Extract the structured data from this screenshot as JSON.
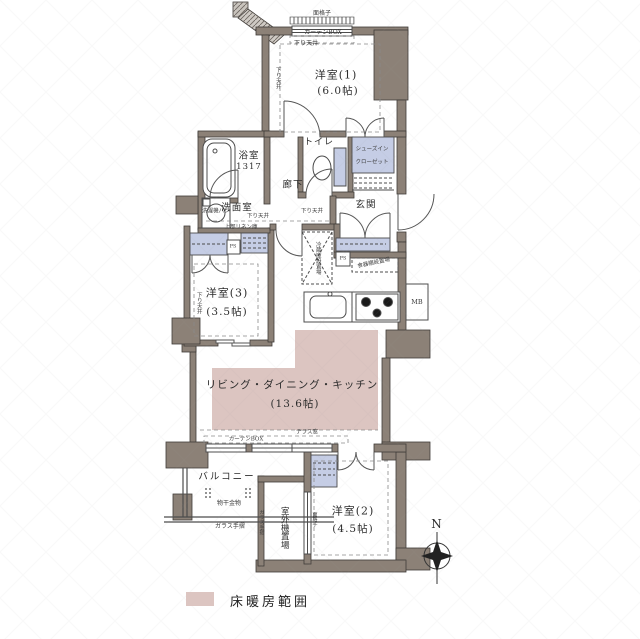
{
  "plan": {
    "rooms": {
      "western1": {
        "name": "洋室(1)",
        "size": "(6.0帖)"
      },
      "western2": {
        "name": "洋室(2)",
        "size": "(4.5帖)"
      },
      "western3": {
        "name": "洋室(3)",
        "size": "(3.5帖)"
      },
      "ldk": {
        "name": "リビング・ダイニング・キッチン",
        "size": "(13.6帖)"
      },
      "bathroom": {
        "name": "浴室",
        "size": "1317"
      },
      "washroom": {
        "name": "洗面室"
      },
      "hallway": {
        "name": "廊下"
      },
      "toilet": {
        "name": "トイレ"
      },
      "entrance": {
        "name": "玄関"
      },
      "balcony": {
        "name": "バルコニー"
      },
      "outdoor_unit": {
        "name": "室外機置場"
      }
    },
    "annotations": {
      "window_grate": "面格子",
      "curtain_box": "カーテンBOX",
      "dropped_ceiling": "下り天井",
      "washer_pan": "洗濯機パン",
      "upper_linen": "上部リネン庫",
      "shoes_closet_line1": "シューズイン",
      "shoes_closet_line2": "クローゼット",
      "fridge_space": "冷蔵庫設置場",
      "cupboard_space": "食器棚設置場",
      "pipe_space": "PS",
      "meter_box": "MB",
      "terrace_window": "テラス窓",
      "laundry_hardware": "物干金物",
      "glass_railing": "ガラス手摺"
    },
    "compass": {
      "north": "N"
    },
    "legend": {
      "floor_heating": "床暖房範囲"
    },
    "colors": {
      "wall": "#8c8177",
      "fixture_blue": "#c5cde5",
      "floor_heating": "#dcc5c1",
      "line": "#4c4c4c"
    }
  }
}
